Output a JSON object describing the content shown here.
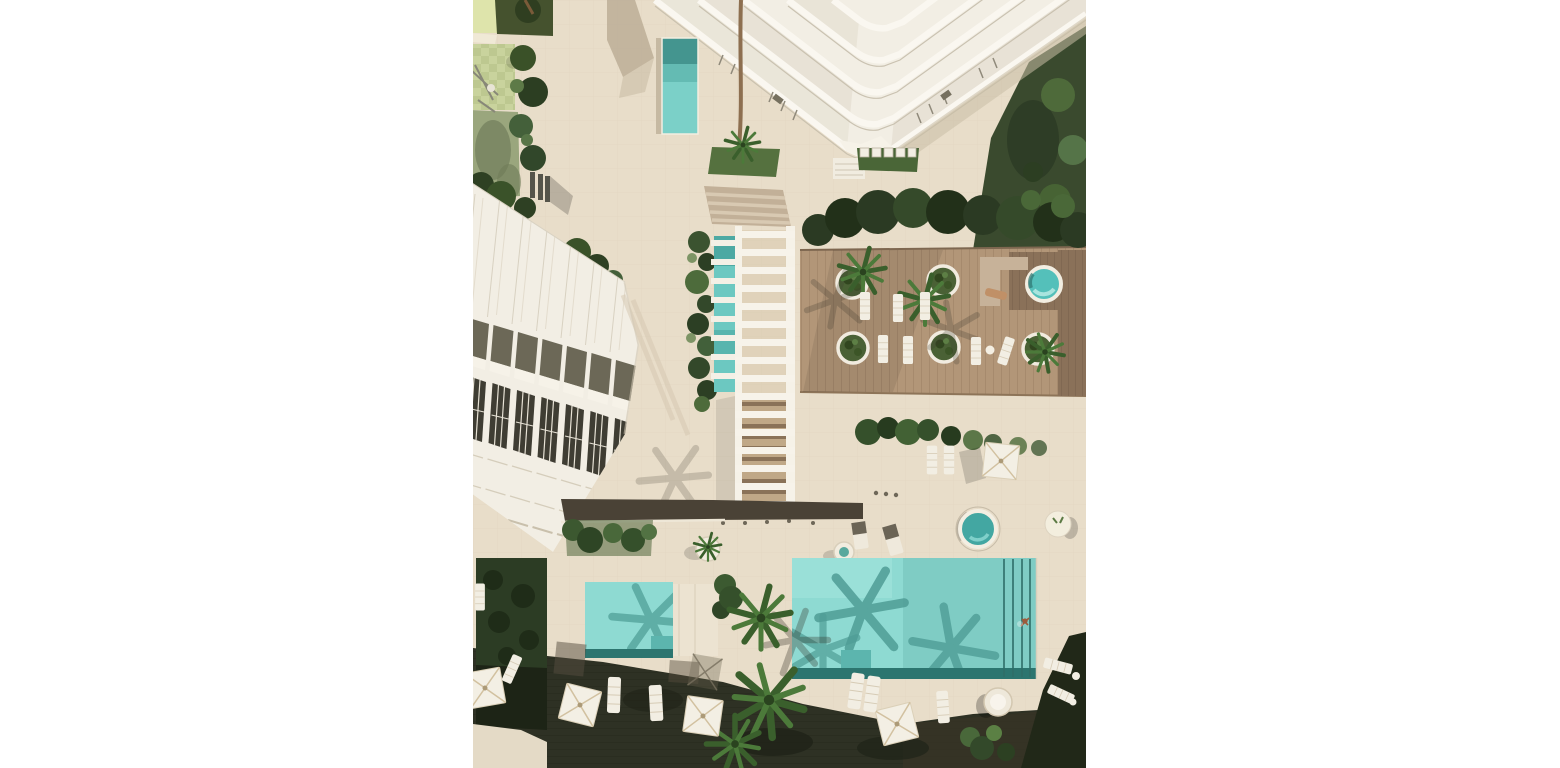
{
  "scene": {
    "description": "Top-down aerial 3D architectural rendering of a coastal residential resort: a stepped white high-rise tower at top, a diagonal row of white townhouses at left, a slatted pergola walkway with stairs and a water channel in the middle, a timber sun deck with round palm planters and a hot tub at right, two turquoise swimming pools below with palm trees, white parasols and sun loungers on a dark boardwalk.",
    "camera": "orthographic top-down",
    "lighting": "sunny daylight with hard diagonal shadows"
  },
  "canvas": {
    "width": 1560,
    "height": 768,
    "content_left": 473,
    "content_width": 613,
    "margin_color": "#ffffff"
  },
  "colors": {
    "pavement": "#e8ddc9",
    "pavement_line": "#dfd3bd",
    "pool_water": "#8edad2",
    "pool_edge_dark": "#2c756f",
    "pool_shadow": "#57a79f",
    "pool_step": "#5cb5ae",
    "lap_pool": "#7bd0c8",
    "lap_pool_dark": "#44958f",
    "hot_tub": "#54c0ba",
    "water_channel": "#6cc8c1",
    "deck_wood": "#b29678",
    "platform_wood": "#8a7159",
    "boardwalk_dark": "#2e3124",
    "lawn_dark": "#3a4a2e",
    "hedge_dark": "#2c3c24",
    "grass": "#55713f",
    "building_white": "#f2eee4",
    "building_inset": "#6c6857",
    "window_dark": "#3f3d33",
    "walkway_wall": "#4a4236",
    "wood_steps": "#c0a887",
    "structure_white": "#f6f2e8",
    "parasol_white": "#f3efe4",
    "sand_path": "#e4dac6",
    "playground_pale": "#c9d39d",
    "playground_sage": "#9aa67d"
  },
  "objects": {
    "tower": "stepped high-rise tower with terraced balconies, top centre",
    "townhouse_row": "seven stepped townhouses with roof terraces, left",
    "pergola_walkway": "white slatted pergola over stairs and a teal water channel",
    "sun_deck": "timber deck with round palm planters, loungers and hot tub",
    "main_pool": "large rectangular pool with lane steps and one swimmer",
    "kids_pool": "small rectangular pool with corner steps",
    "lap_pool": "narrow pool at the tower base",
    "hot_tub_count": 2,
    "round_planter_count": 6,
    "parasol_count": 5,
    "sun_lounger_count": 18,
    "playground": "small play lawn with trees, top left",
    "people": "one swimmer in the main pool, one sunbather on the deck bench"
  }
}
